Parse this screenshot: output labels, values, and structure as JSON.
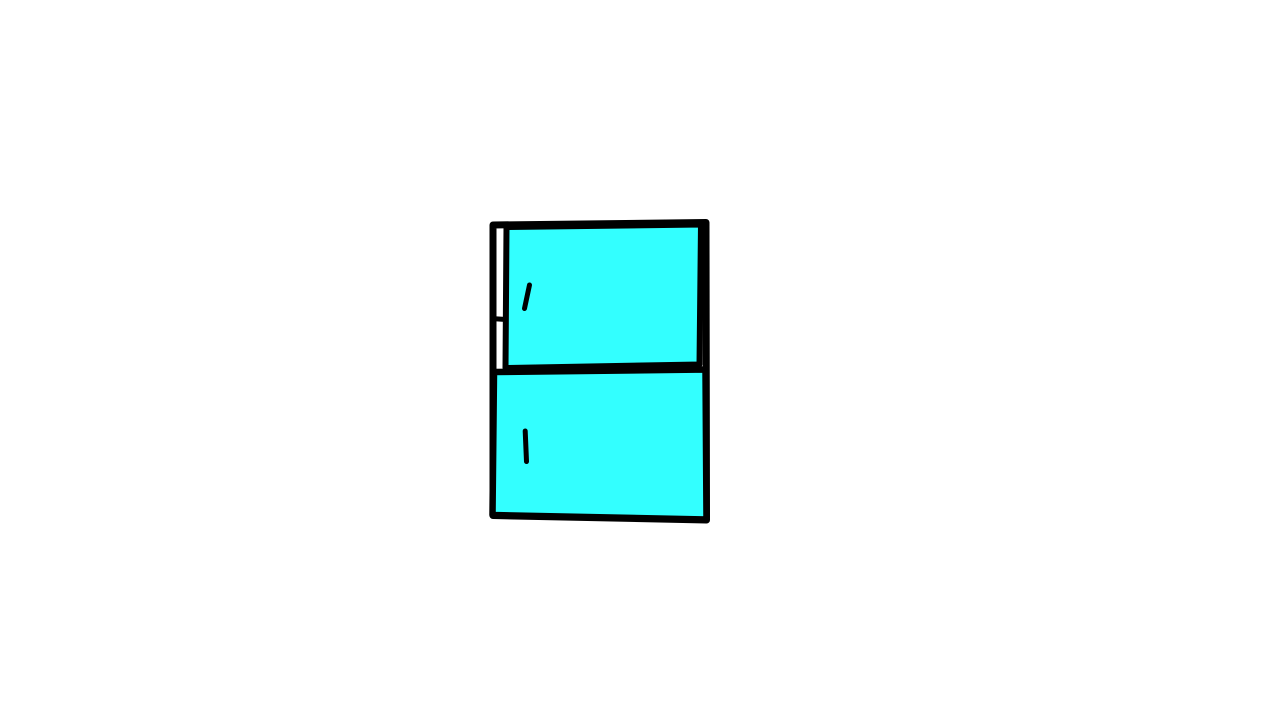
{
  "illustration": {
    "subject": "two-door refrigerator with top freezer compartment",
    "style": "hand-drawn black outline drawing with flat fill, centered on plain white background"
  },
  "colors": {
    "background": "#ffffff",
    "outline": "#000000",
    "door_fill": "#33ffff"
  },
  "parts": [
    "cabinet-frame",
    "hinge-gap",
    "hinge-gap-tick",
    "freezer-door",
    "freezer-door-handle",
    "refrigerator-door",
    "refrigerator-door-handle"
  ]
}
